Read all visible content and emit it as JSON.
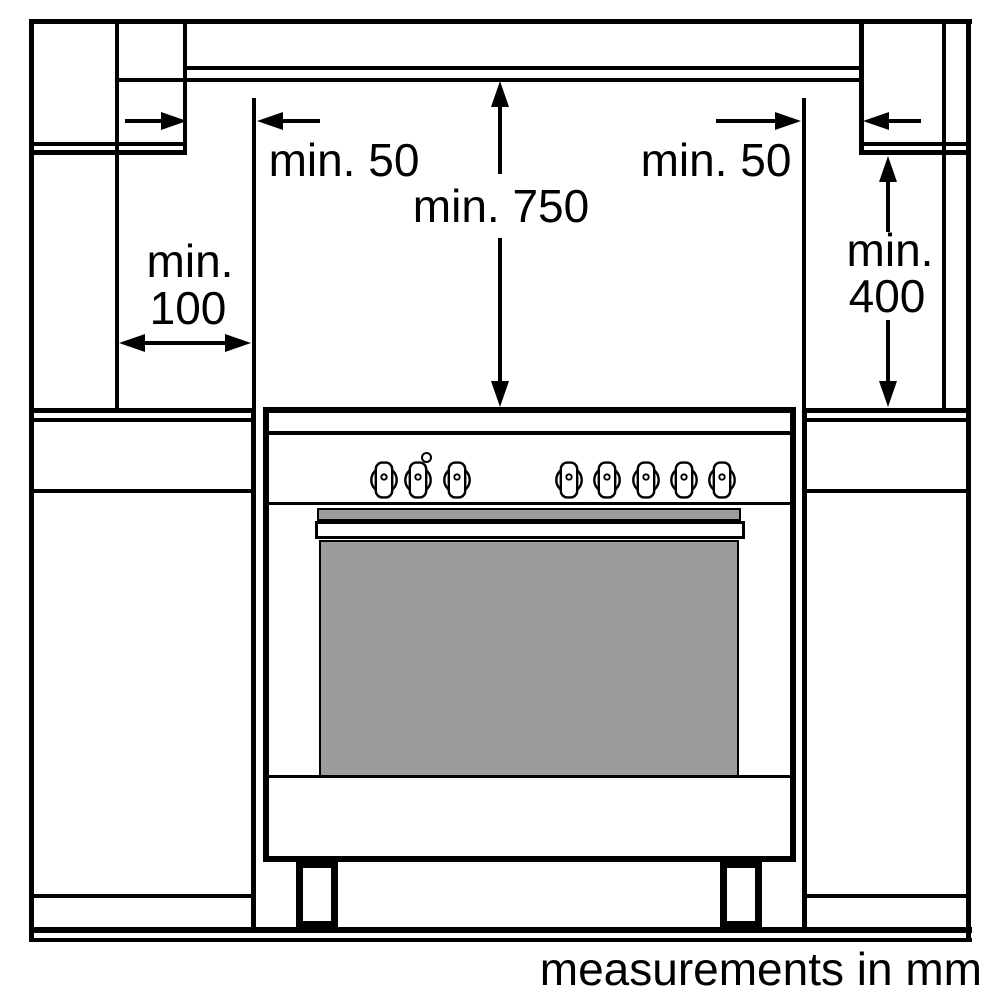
{
  "labels": {
    "left_clearance": "min. 50",
    "right_clearance": "min. 50",
    "vertical_clearance": "min. 750",
    "left_depth_line1": "min.",
    "left_depth_line2": "100",
    "right_height_line1": "min.",
    "right_height_line2": "400",
    "footer": "measurements in mm"
  },
  "colors": {
    "line": "#000000",
    "background": "#ffffff",
    "door_gray": "#9c9c9c"
  },
  "cooker": {
    "knobs": {
      "count": 8,
      "centers_x": [
        384,
        418,
        457,
        569,
        607,
        646,
        684,
        722
      ],
      "center_y": 480
    },
    "indicator_light": {
      "x": 427,
      "y": 458
    }
  }
}
